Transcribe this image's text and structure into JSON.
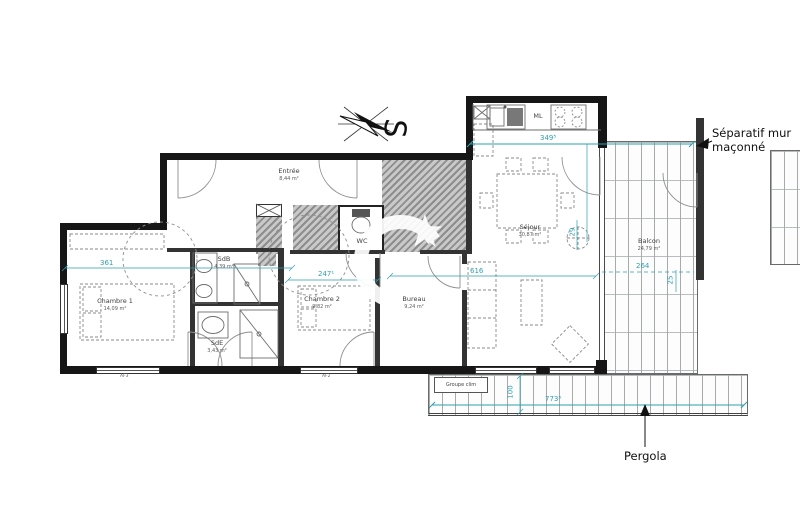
{
  "rooms": {
    "entree": {
      "name": "Entrée",
      "area": "8,44 m²"
    },
    "chambre1": {
      "name": "Chambre 1",
      "area": "14,09 m²"
    },
    "sdb": {
      "name": "SdB",
      "area": "4,39 m²"
    },
    "sde": {
      "name": "SdE",
      "area": "3,43 m²"
    },
    "wc": {
      "name": "WC",
      "area": ""
    },
    "chambre2": {
      "name": "Chambre 2",
      "area": "9,82 m²"
    },
    "bureau": {
      "name": "Bureau",
      "area": "9,24 m²"
    },
    "sejour": {
      "name": "Séjour",
      "area": "30,87 m²"
    },
    "balcon": {
      "name": "Balcon",
      "area": "24,79 m²"
    }
  },
  "kitchen": {
    "appliance_label": "ML"
  },
  "annotations": {
    "separatif_wall": "Séparatif mur maçonné",
    "pergola": "Pergola",
    "groupe_clim": "Groupe clim",
    "compass_south": "S"
  },
  "dimensions": {
    "chambre1_width": "361",
    "hall_width": "247¹",
    "kitchen_width": "349⁵",
    "sejour_width": "616",
    "balcony_door": "29",
    "balcon_width": "264",
    "balcon_side": "25",
    "pergola_width": "773⁵",
    "pergola_depth": "100"
  },
  "window_codes": {
    "left": "AF3",
    "middle": "AF2"
  },
  "colors": {
    "dimension_teal": "#2f9fae",
    "wall_black": "#161616",
    "hatch_gray": "#9b9b9b"
  }
}
